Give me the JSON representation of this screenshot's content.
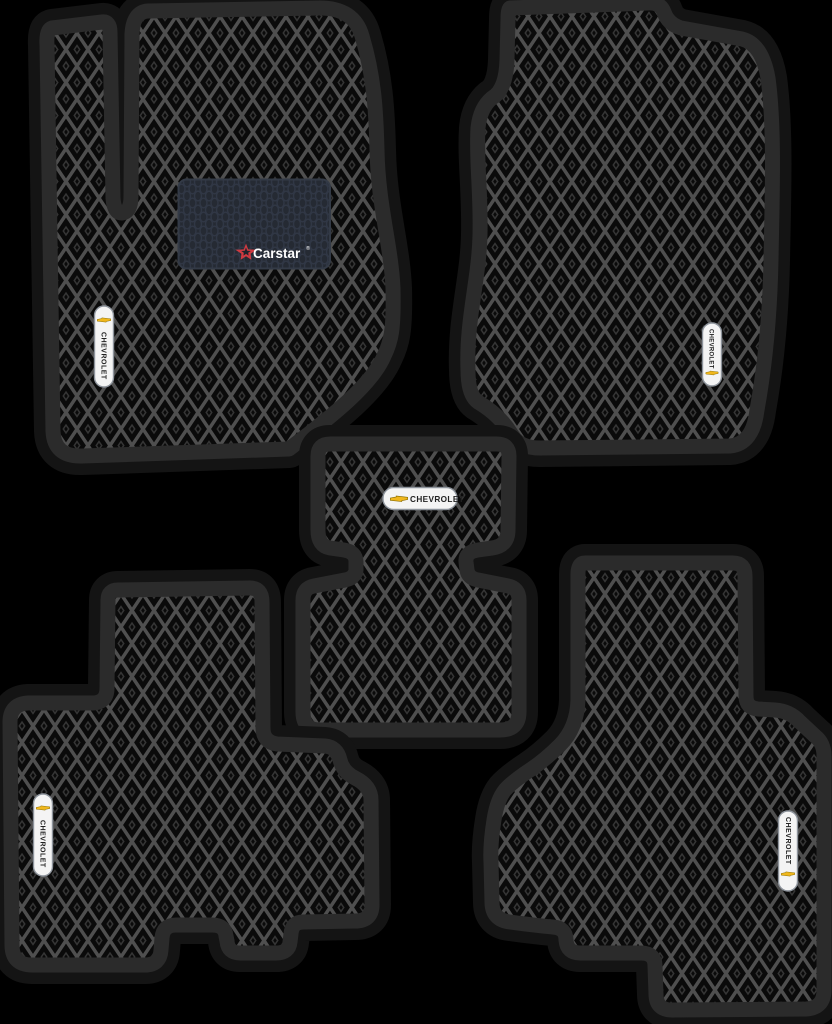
{
  "scene": {
    "background_color": "#000000"
  },
  "mat_style": {
    "border_color": "#2b2b2b",
    "halo_color": "#141414",
    "cell_color": "#0a0a0a",
    "grid_color": "#4f4f4f",
    "dot_color": "#353535"
  },
  "chevrolet_badge": {
    "label": "CHEVROLET",
    "pill_color": "#f4f4f4",
    "pill_border_color": "#8d939b",
    "bowtie_color": "#f0b71c",
    "bowtie_outline_color": "#8a6d00",
    "text_color": "#222222"
  },
  "heel_pad": {
    "brand": "Carstar",
    "registered_mark": "®",
    "pad_color": "#252a33",
    "pad_border_color": "#333a46",
    "ring_color": "#303745",
    "brand_color": "#ffffff",
    "star_color": "#cf3a41",
    "star_core_color": "#20242c"
  }
}
